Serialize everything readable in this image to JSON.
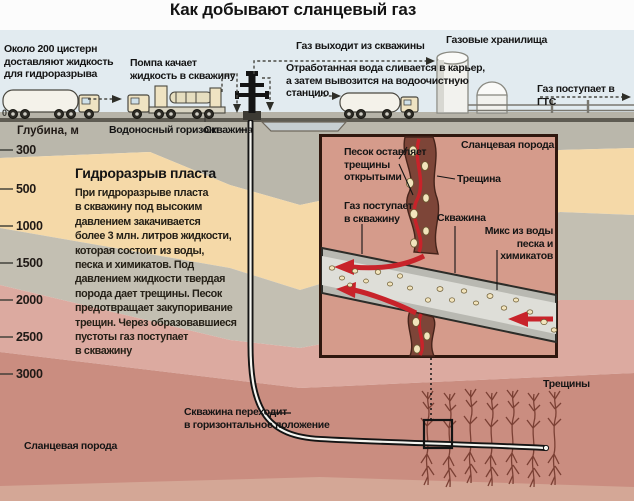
{
  "title": "Как добывают сланцевый газ",
  "surface": {
    "tankers": "Около 200 цистерн\nдоставляют жидкость\nдля гидроразрыва",
    "pump": "Помпа качает\nжидкость в скважину",
    "gas_out": "Газ выходит из скважины",
    "wastewater": "Отработанная вода сливается в карьер,\nа затем вывозится на водоочистную\nстанцию",
    "storage": "Газовые хранилища",
    "gts": "Газ поступает в ГТС",
    "aquifer": "Водоносный горизонт",
    "wellhead": "Скважина"
  },
  "depth": {
    "header": "Глубина, м",
    "zero": "0",
    "ticks": [
      "300",
      "500",
      "1000",
      "1500",
      "2000",
      "2500",
      "3000"
    ]
  },
  "frack": {
    "heading": "Гидроразрыв пласта",
    "body": "При гидроразрыве пласта\nв скважину под высоким\nдавлением закачивается\nболее 3 млн. литров жидкости,\nкоторая состоит из воды,\nпеска и химикатов. Под\nдавлением жидкости твердая\nпорода дает трещины. Песок\nпредотвращает закупоривание\nтрещин. Через образовавшиеся\nпустоты газ поступает\nв скважину"
  },
  "inset": {
    "sand": "Песок оставляет\nтрещины\nоткрытыми",
    "shale": "Сланцевая порода",
    "crack": "Трещина",
    "gas_in": "Газ поступает\nв скважину",
    "well": "Скважина",
    "mix": "Микс из воды\nпеска и химикатов"
  },
  "bottom": {
    "horizontal_well": "Скважина переходит\nв горизонтальное положение",
    "fractures": "Трещины",
    "shale": "Сланцевая порода"
  },
  "colors": {
    "red_arrow": "#c8232a",
    "shale_pink": "#ca8d80",
    "sand_layer": "#f5d9a8",
    "aquifer_gray": "#bab7ab",
    "inset_bg": "#d59b8b",
    "sky": "#e2ebf0"
  }
}
